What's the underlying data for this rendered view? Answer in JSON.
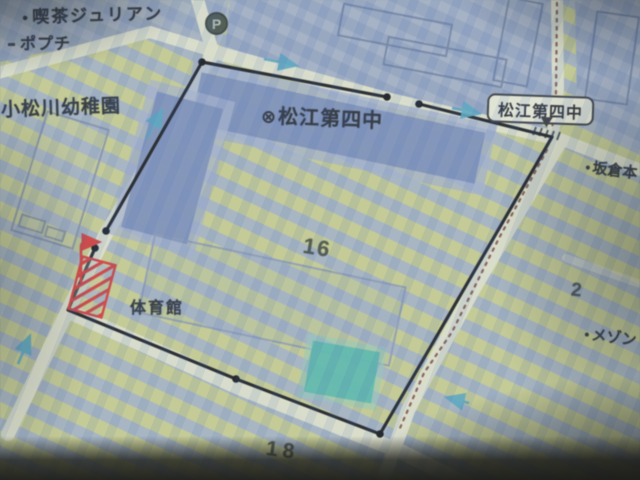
{
  "map": {
    "type": "photographed-street-map",
    "labels": {
      "cafe_bullet": "●",
      "cafe": "喫茶ジュリアン",
      "popuchi": "ポプチ",
      "kindergarten": "小松川幼稚園",
      "school_symbol": "⊗",
      "school_name": "松江第四中",
      "callout_school": "松江第四中",
      "parking": "P",
      "sakakura_bullet": "●",
      "sakakura": "坂倉本",
      "block_16": "16",
      "gym": "体育館",
      "block_2": "2",
      "maison_bullet": "●",
      "maison": "メゾン",
      "block_18": "18"
    },
    "annotations": {
      "boundary": "black polygon with vertex dots around school block",
      "red_marker": "red diagonal-hatched rectangle with red bent arrow",
      "one_way_arrows": 5,
      "dotted_route": "maroon dotted line along right-side road"
    },
    "colors": {
      "boundary": "#17171f",
      "marker_red": "#e43636",
      "arrow_cyan": "#4fa8c8",
      "route_dotted": "#7a3a35",
      "road": "#e8e8d1",
      "field_block": "#ccd08d",
      "building_block": "#97a6c6",
      "building": "#7b8ec0",
      "pool_teal": "#4fbcae",
      "callout_bg": "#efeedb"
    }
  }
}
